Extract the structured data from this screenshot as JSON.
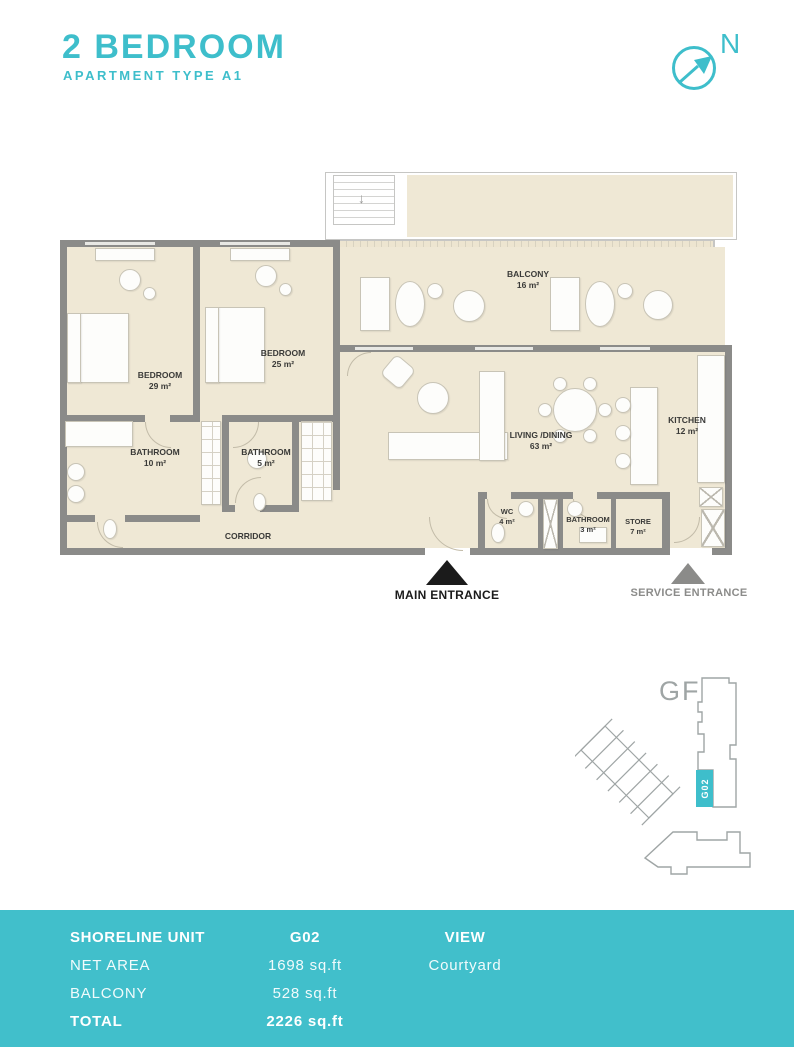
{
  "header": {
    "title": "2 BEDROOM",
    "subtitle": "APARTMENT TYPE A1",
    "compass_label": "N"
  },
  "floorplan": {
    "rooms": [
      {
        "name": "BEDROOM",
        "area": "29 m²"
      },
      {
        "name": "BEDROOM",
        "area": "25 m²"
      },
      {
        "name": "BATHROOM",
        "area": "10 m²"
      },
      {
        "name": "BATHROOM",
        "area": "5 m²"
      },
      {
        "name": "BALCONY",
        "area": "16 m²"
      },
      {
        "name": "LIVING /DINING",
        "area": "63 m²"
      },
      {
        "name": "KITCHEN",
        "area": "12 m²"
      },
      {
        "name": "WC",
        "area": "4 m²"
      },
      {
        "name": "BATHROOM",
        "area": "3 m²"
      },
      {
        "name": "STORE",
        "area": "7 m²"
      },
      {
        "name": "CORRIDOR",
        "area": ""
      }
    ],
    "entrances": {
      "main": "MAIN ENTRANCE",
      "service": "SERVICE ENTRANCE"
    }
  },
  "keyplan": {
    "floor_label": "GF",
    "unit_label": "G02"
  },
  "summary": {
    "unit_header": "SHORELINE UNIT",
    "unit_value": "G02",
    "view_header": "VIEW",
    "net_area_label": "NET AREA",
    "net_area_value": "1698 sq.ft",
    "view_value": "Courtyard",
    "balcony_label": "BALCONY",
    "balcony_value": "528 sq.ft",
    "total_label": "TOTAL",
    "total_value": "2226 sq.ft"
  },
  "colors": {
    "teal": "#3EBECB",
    "floor_cream": "#EFE8D5",
    "wall_gray": "#8B8B89"
  }
}
